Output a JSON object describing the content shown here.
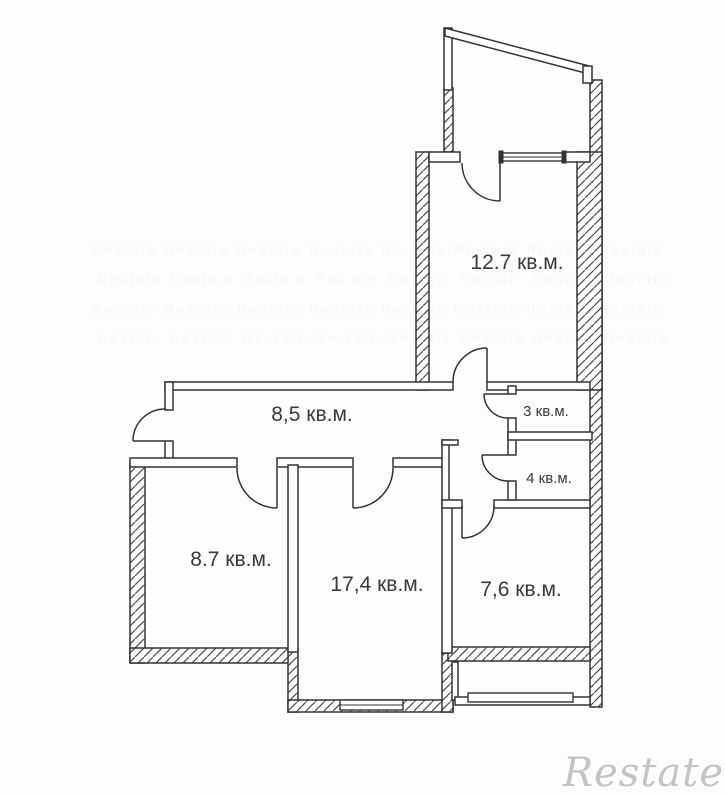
{
  "page": {
    "background": "#fdfdfe",
    "wall_color": "#333333",
    "label_color": "#3a3a3a",
    "watermark_color": "#c3c3c8"
  },
  "floor_plan": {
    "type": "apartment-floor-plan",
    "unit": "кв.м.",
    "rooms": {
      "r127": {
        "label": "12.7 кв.м.",
        "area": "12.7"
      },
      "hall": {
        "label": "8,5 кв.м.",
        "area": "8,5"
      },
      "wc3": {
        "label": "3 кв.м.",
        "area": "3"
      },
      "wc4": {
        "label": "4 кв.м.",
        "area": "4"
      },
      "r87": {
        "label": "8.7 кв.м.",
        "area": "8.7"
      },
      "r174": {
        "label": "17,4 кв.м.",
        "area": "17,4"
      },
      "r76": {
        "label": "7,6 кв.м.",
        "area": "7,6"
      }
    }
  },
  "watermark": {
    "brand": "Restate",
    "tiled_row": "Restate Restate Restate Restate Restate Restate Restate Restate"
  }
}
